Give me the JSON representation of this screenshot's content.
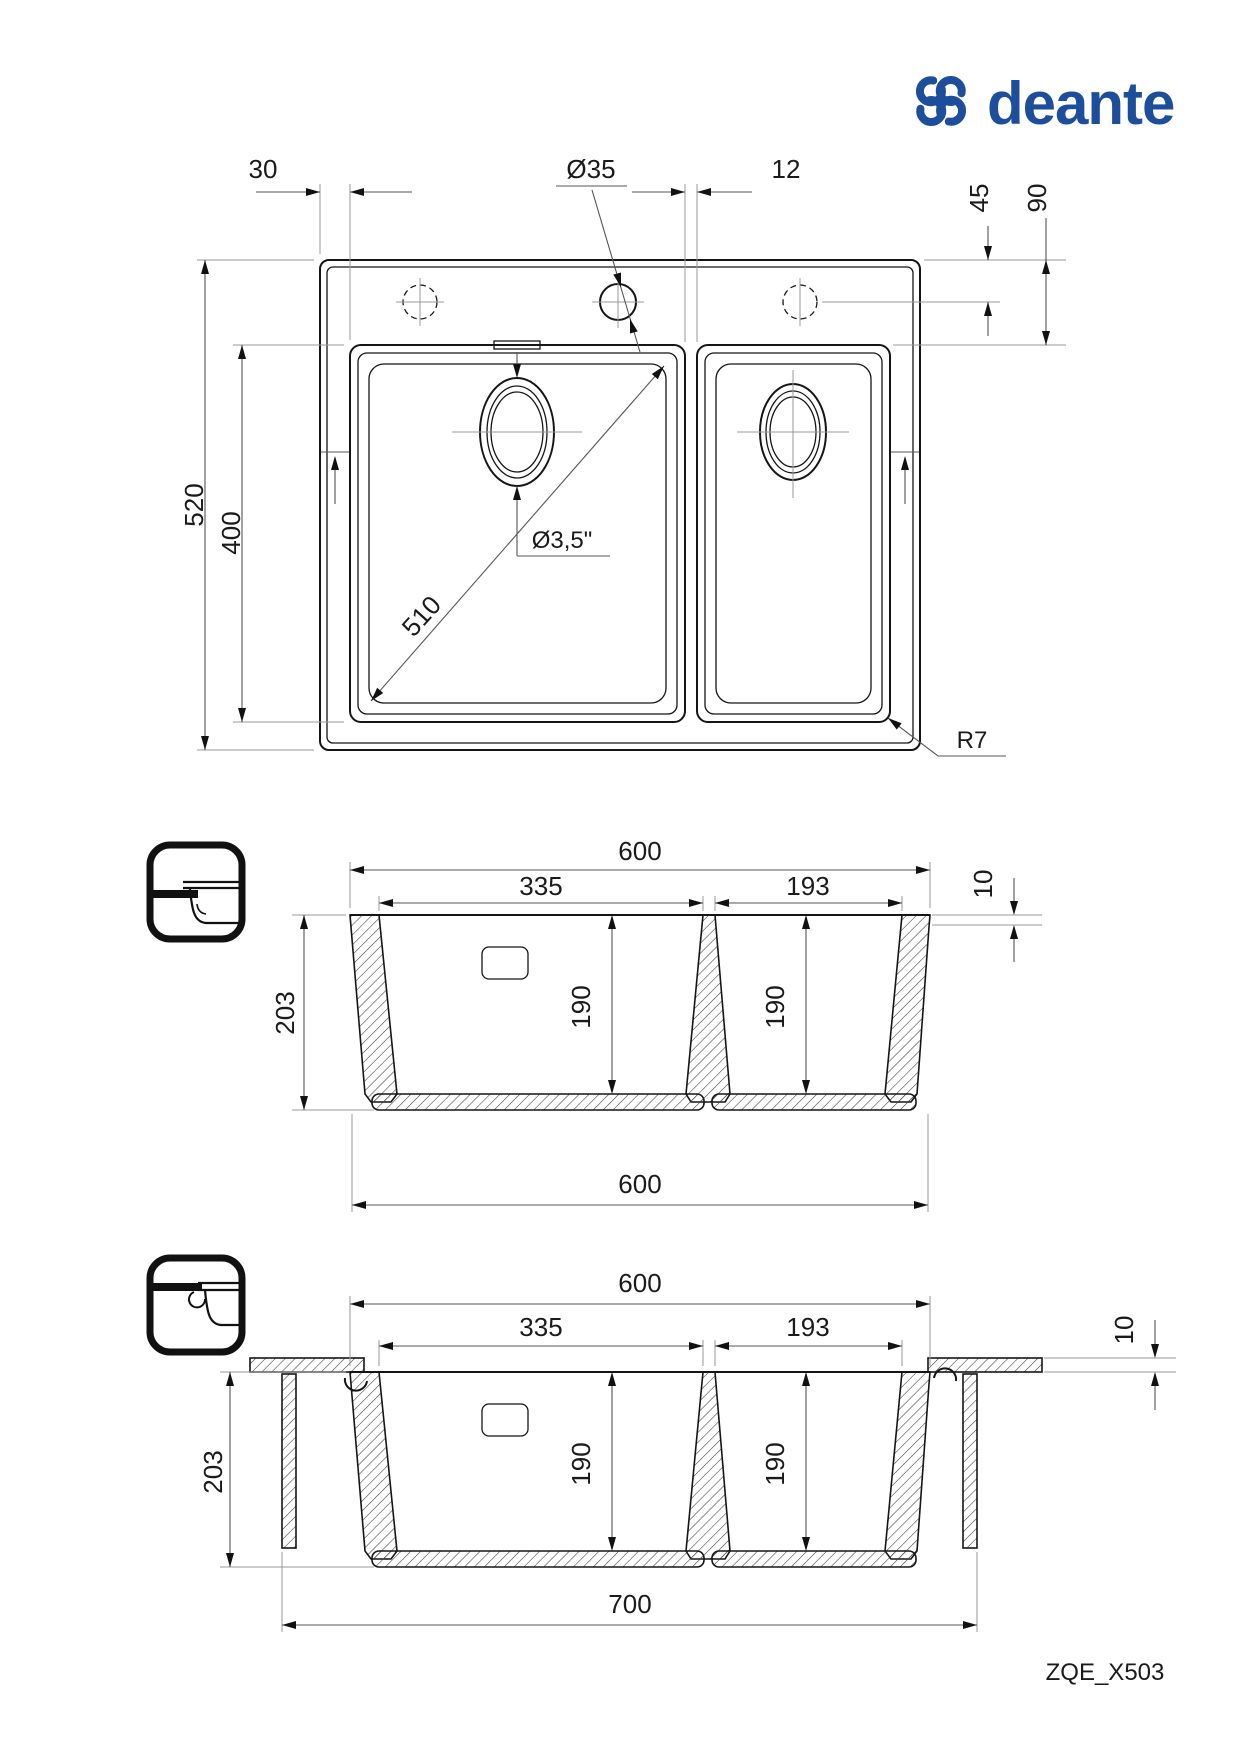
{
  "brand": {
    "name": "deante",
    "color": "#1d4e9b"
  },
  "model_code": "ZQE_X503",
  "top_view": {
    "dims": {
      "left_offset": "30",
      "faucet_hole_diameter": "Ø35",
      "bowl_gap": "12",
      "hole_center_from_edge": "45",
      "bowl_from_edge": "90",
      "overall_depth": "520",
      "bowl_length": "400",
      "bowl_diagonal": "510",
      "drain_diameter": "Ø3,5\"",
      "corner_radius": "R7"
    }
  },
  "section_inset": {
    "dims": {
      "overall_width": "600",
      "main_bowl_width": "335",
      "small_bowl_width": "193",
      "rim_thickness": "10",
      "overall_height": "203",
      "main_bowl_depth": "190",
      "small_bowl_depth": "190",
      "base_width": "600"
    }
  },
  "section_flush": {
    "dims": {
      "overall_width": "600",
      "main_bowl_width": "335",
      "small_bowl_width": "193",
      "rim_thickness": "10",
      "overall_height": "203",
      "main_bowl_depth": "190",
      "small_bowl_depth": "190",
      "cutout_width": "700"
    }
  },
  "icons": {
    "inset": "top-mount-section-icon",
    "flush": "flush-mount-section-icon"
  }
}
